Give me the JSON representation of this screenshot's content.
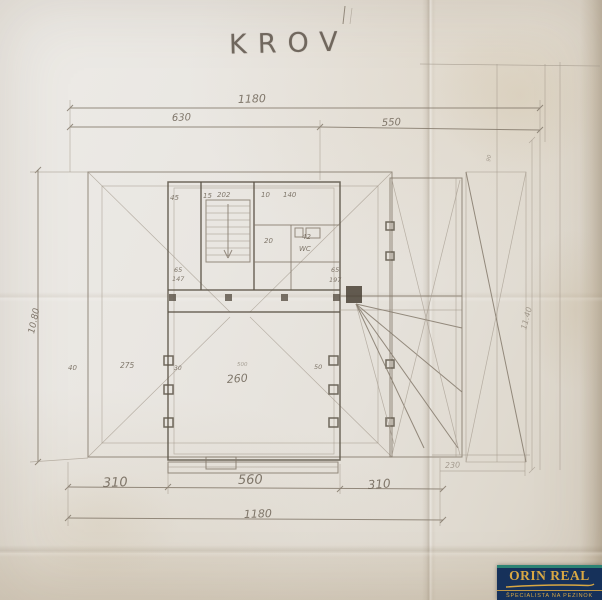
{
  "plan": {
    "title": "KROV",
    "labels": [
      {
        "id": "dim-top-total",
        "text": "1180"
      },
      {
        "id": "dim-top-left",
        "text": "630"
      },
      {
        "id": "dim-top-right",
        "text": "550"
      },
      {
        "id": "dim-bottom-left",
        "text": "310"
      },
      {
        "id": "dim-bottom-mid",
        "text": "560"
      },
      {
        "id": "dim-bottom-right",
        "text": "310"
      },
      {
        "id": "dim-bottom-total",
        "text": "1180"
      },
      {
        "id": "dim-left-height",
        "text": "10.80"
      },
      {
        "id": "dim-right-height",
        "text": "11.40"
      },
      {
        "id": "dim-room-45",
        "text": "45"
      },
      {
        "id": "dim-room-15",
        "text": "15"
      },
      {
        "id": "dim-room-202",
        "text": "202"
      },
      {
        "id": "dim-room-10",
        "text": "10"
      },
      {
        "id": "dim-room-140",
        "text": "140"
      },
      {
        "id": "dim-landing-20",
        "text": "20"
      },
      {
        "id": "dim-wc-42",
        "text": "42"
      },
      {
        "id": "room-wc",
        "text": "WC"
      },
      {
        "id": "dim-left-65",
        "text": "65"
      },
      {
        "id": "dim-left-147",
        "text": "147"
      },
      {
        "id": "dim-right-65",
        "text": "65"
      },
      {
        "id": "dim-right-197",
        "text": "197"
      },
      {
        "id": "dim-40",
        "text": "40"
      },
      {
        "id": "dim-275",
        "text": "275"
      },
      {
        "id": "dim-30",
        "text": "30"
      },
      {
        "id": "dim-500",
        "text": "500"
      },
      {
        "id": "room-note-260",
        "text": "260"
      },
      {
        "id": "dim-50",
        "text": "50"
      },
      {
        "id": "dim-annex-230",
        "text": "230"
      },
      {
        "id": "dim-annex-90",
        "text": "90"
      }
    ]
  },
  "watermark": {
    "brand": "ORIN REAL",
    "tagline": "ŠPECIALISTA NA PEZINOK",
    "colors": {
      "background": "#16315a",
      "gold": "#d9a843",
      "teal": "#2d8374"
    }
  },
  "colors": {
    "paper": "#e8e4de",
    "pencil": "#6a6055"
  }
}
